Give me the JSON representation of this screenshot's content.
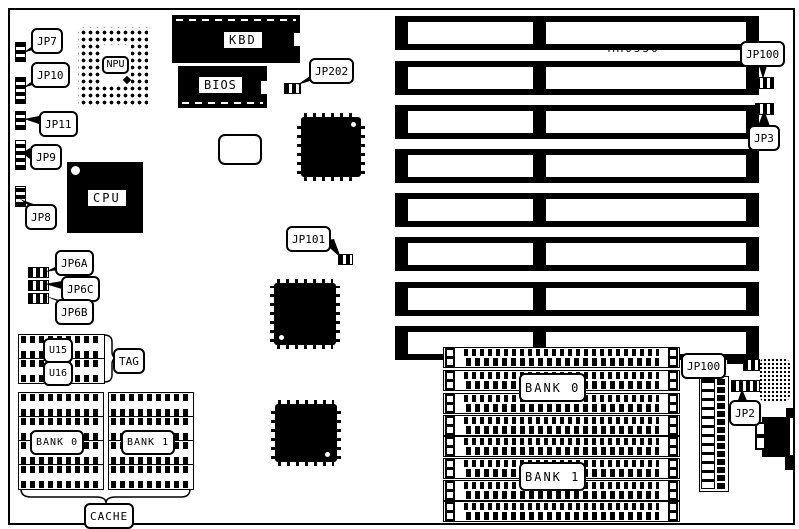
{
  "board": {
    "model": "MH0550",
    "colors": {
      "ink": "#000000",
      "paper": "#ffffff"
    }
  },
  "labels": {
    "jp7": "JP7",
    "jp10": "JP10",
    "jp11": "JP11",
    "jp9": "JP9",
    "jp8": "JP8",
    "jp6a": "JP6A",
    "jp6c": "JP6C",
    "jp6b": "JP6B",
    "jp202": "JP202",
    "jp101": "JP101",
    "jp100_top": "JP100",
    "jp3": "JP3",
    "jp100_bottom": "JP100",
    "jp2": "JP2",
    "npu": "NPU",
    "cpu": "CPU",
    "kbd": "KBD",
    "bios": "BIOS",
    "u15": "U15",
    "u16": "U16",
    "tag": "TAG",
    "cache_bank0": "BANK 0",
    "cache_bank1": "BANK 1",
    "cache": "CACHE",
    "mem_bank0": "BANK 0",
    "mem_bank1": "BANK 1"
  },
  "structure": {
    "isa_slot_count": 8,
    "memory_banks": 2,
    "simm_sockets_per_bank": 4,
    "cache_chips_per_bank": 4,
    "tag_chips": 2
  }
}
